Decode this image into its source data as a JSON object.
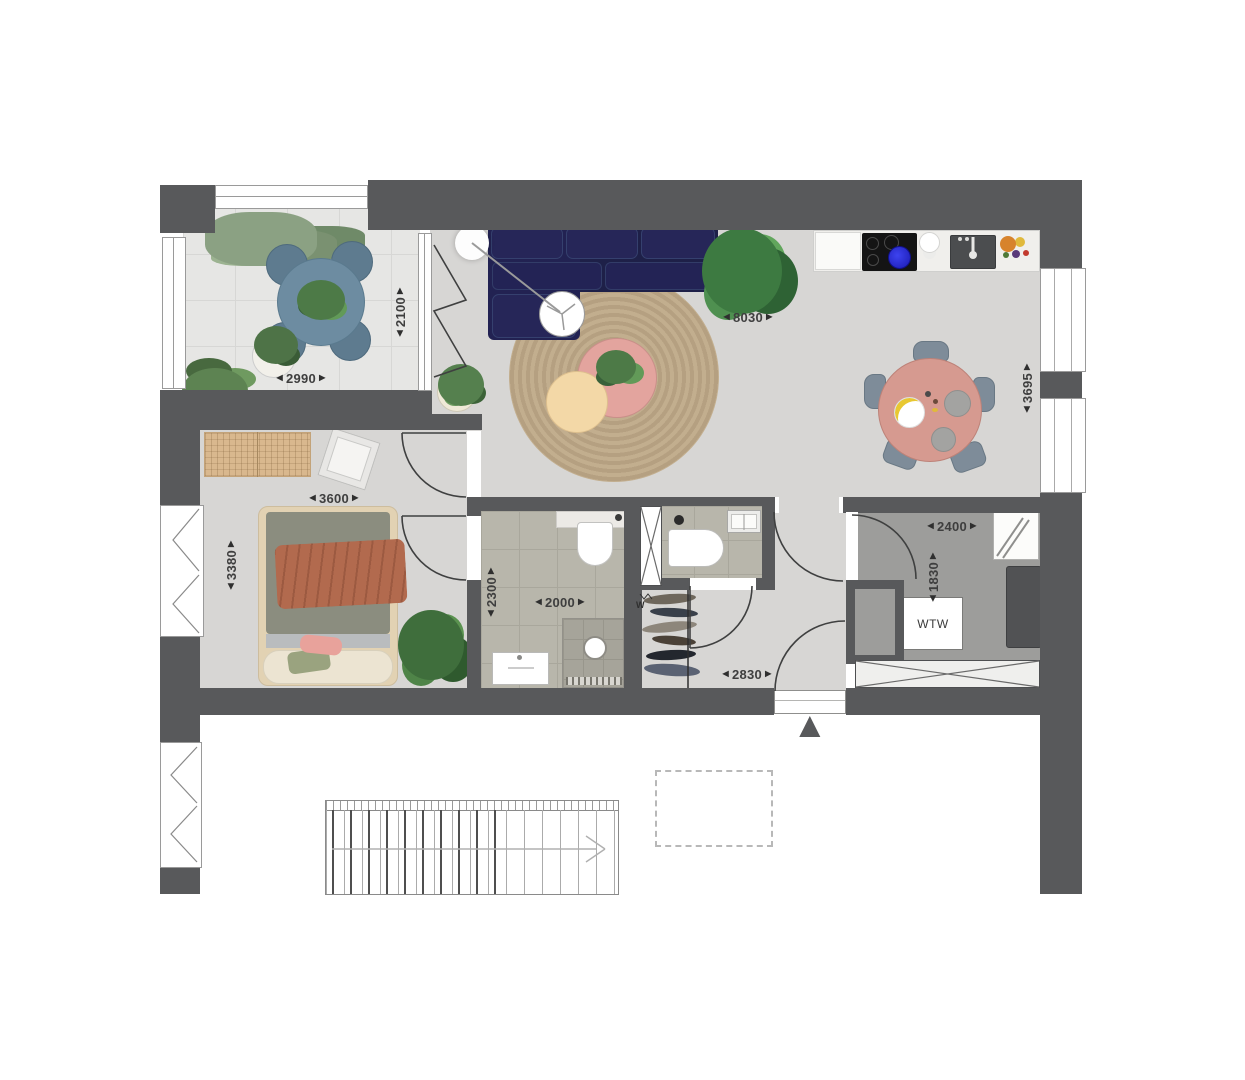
{
  "plan": {
    "type": "apartment-floor-plan",
    "unit": "mm"
  },
  "dimensions": {
    "balcony_width": {
      "value": "2990",
      "orientation": "horizontal",
      "room": "balcony"
    },
    "balcony_depth": {
      "value": "2100",
      "orientation": "vertical",
      "room": "balcony"
    },
    "living_width": {
      "value": "8030",
      "orientation": "horizontal",
      "room": "living-room"
    },
    "living_depth": {
      "value": "3695",
      "orientation": "vertical",
      "room": "living-room"
    },
    "bedroom_width": {
      "value": "3600",
      "orientation": "horizontal",
      "room": "bedroom"
    },
    "bedroom_depth": {
      "value": "3380",
      "orientation": "vertical",
      "room": "bedroom"
    },
    "bathroom_width": {
      "value": "2000",
      "orientation": "horizontal",
      "room": "bathroom"
    },
    "bathroom_depth": {
      "value": "2300",
      "orientation": "vertical",
      "room": "bathroom"
    },
    "tech_width": {
      "value": "2400",
      "orientation": "horizontal",
      "room": "technical-room"
    },
    "tech_depth": {
      "value": "1830",
      "orientation": "vertical",
      "room": "technical-room"
    },
    "hall_width": {
      "value": "2830",
      "orientation": "horizontal",
      "room": "hall"
    }
  },
  "labels": {
    "wtw_unit": "WTW",
    "meter": "W"
  },
  "icons": {
    "dim_arrow_left": "◀",
    "dim_arrow_right": "▶",
    "entrance_arrow": "▲"
  },
  "colors": {
    "wall": "#58595b",
    "floor": "#d7d6d4",
    "balcony_floor": "#e6e6e4",
    "tile_floor": "#b8b6ab",
    "tech_floor": "#9d9d9b",
    "sofa": "#232355",
    "rug": "#c2ae8e",
    "dining_table": "#d69a90",
    "coffee_table": "#e3a49e",
    "side_table": "#f3d8a7",
    "balcony_table": "#6d8ca1",
    "bed_blanket": "#b26a4e",
    "bed_mattress": "#8b8d7f"
  }
}
